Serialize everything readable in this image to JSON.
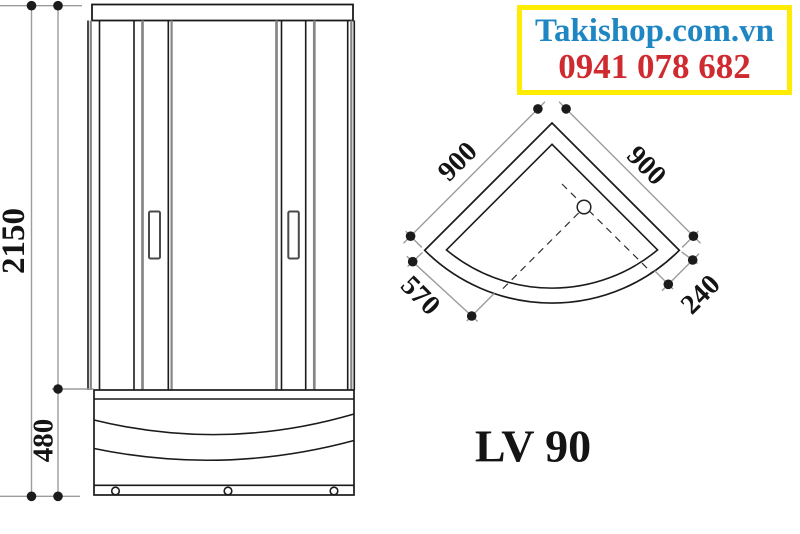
{
  "banner": {
    "website": "Takishop.com.vn",
    "phone": "0941 078 682"
  },
  "model": {
    "name": "LV 90"
  },
  "front_view": {
    "overall_height_mm": "2150",
    "base_height_mm": "480"
  },
  "plan_view": {
    "left_side_mm": "900",
    "right_side_mm": "900",
    "front_left_mm": "570",
    "front_right_mm": "240"
  },
  "colors": {
    "site_blue": "#1e86c3",
    "phone_red": "#cf2a2f",
    "box_yellow": "#ffec00",
    "line_black": "#1b1b1b",
    "dim_gray": "#9c9c9c",
    "frame_gray": "#868686"
  }
}
